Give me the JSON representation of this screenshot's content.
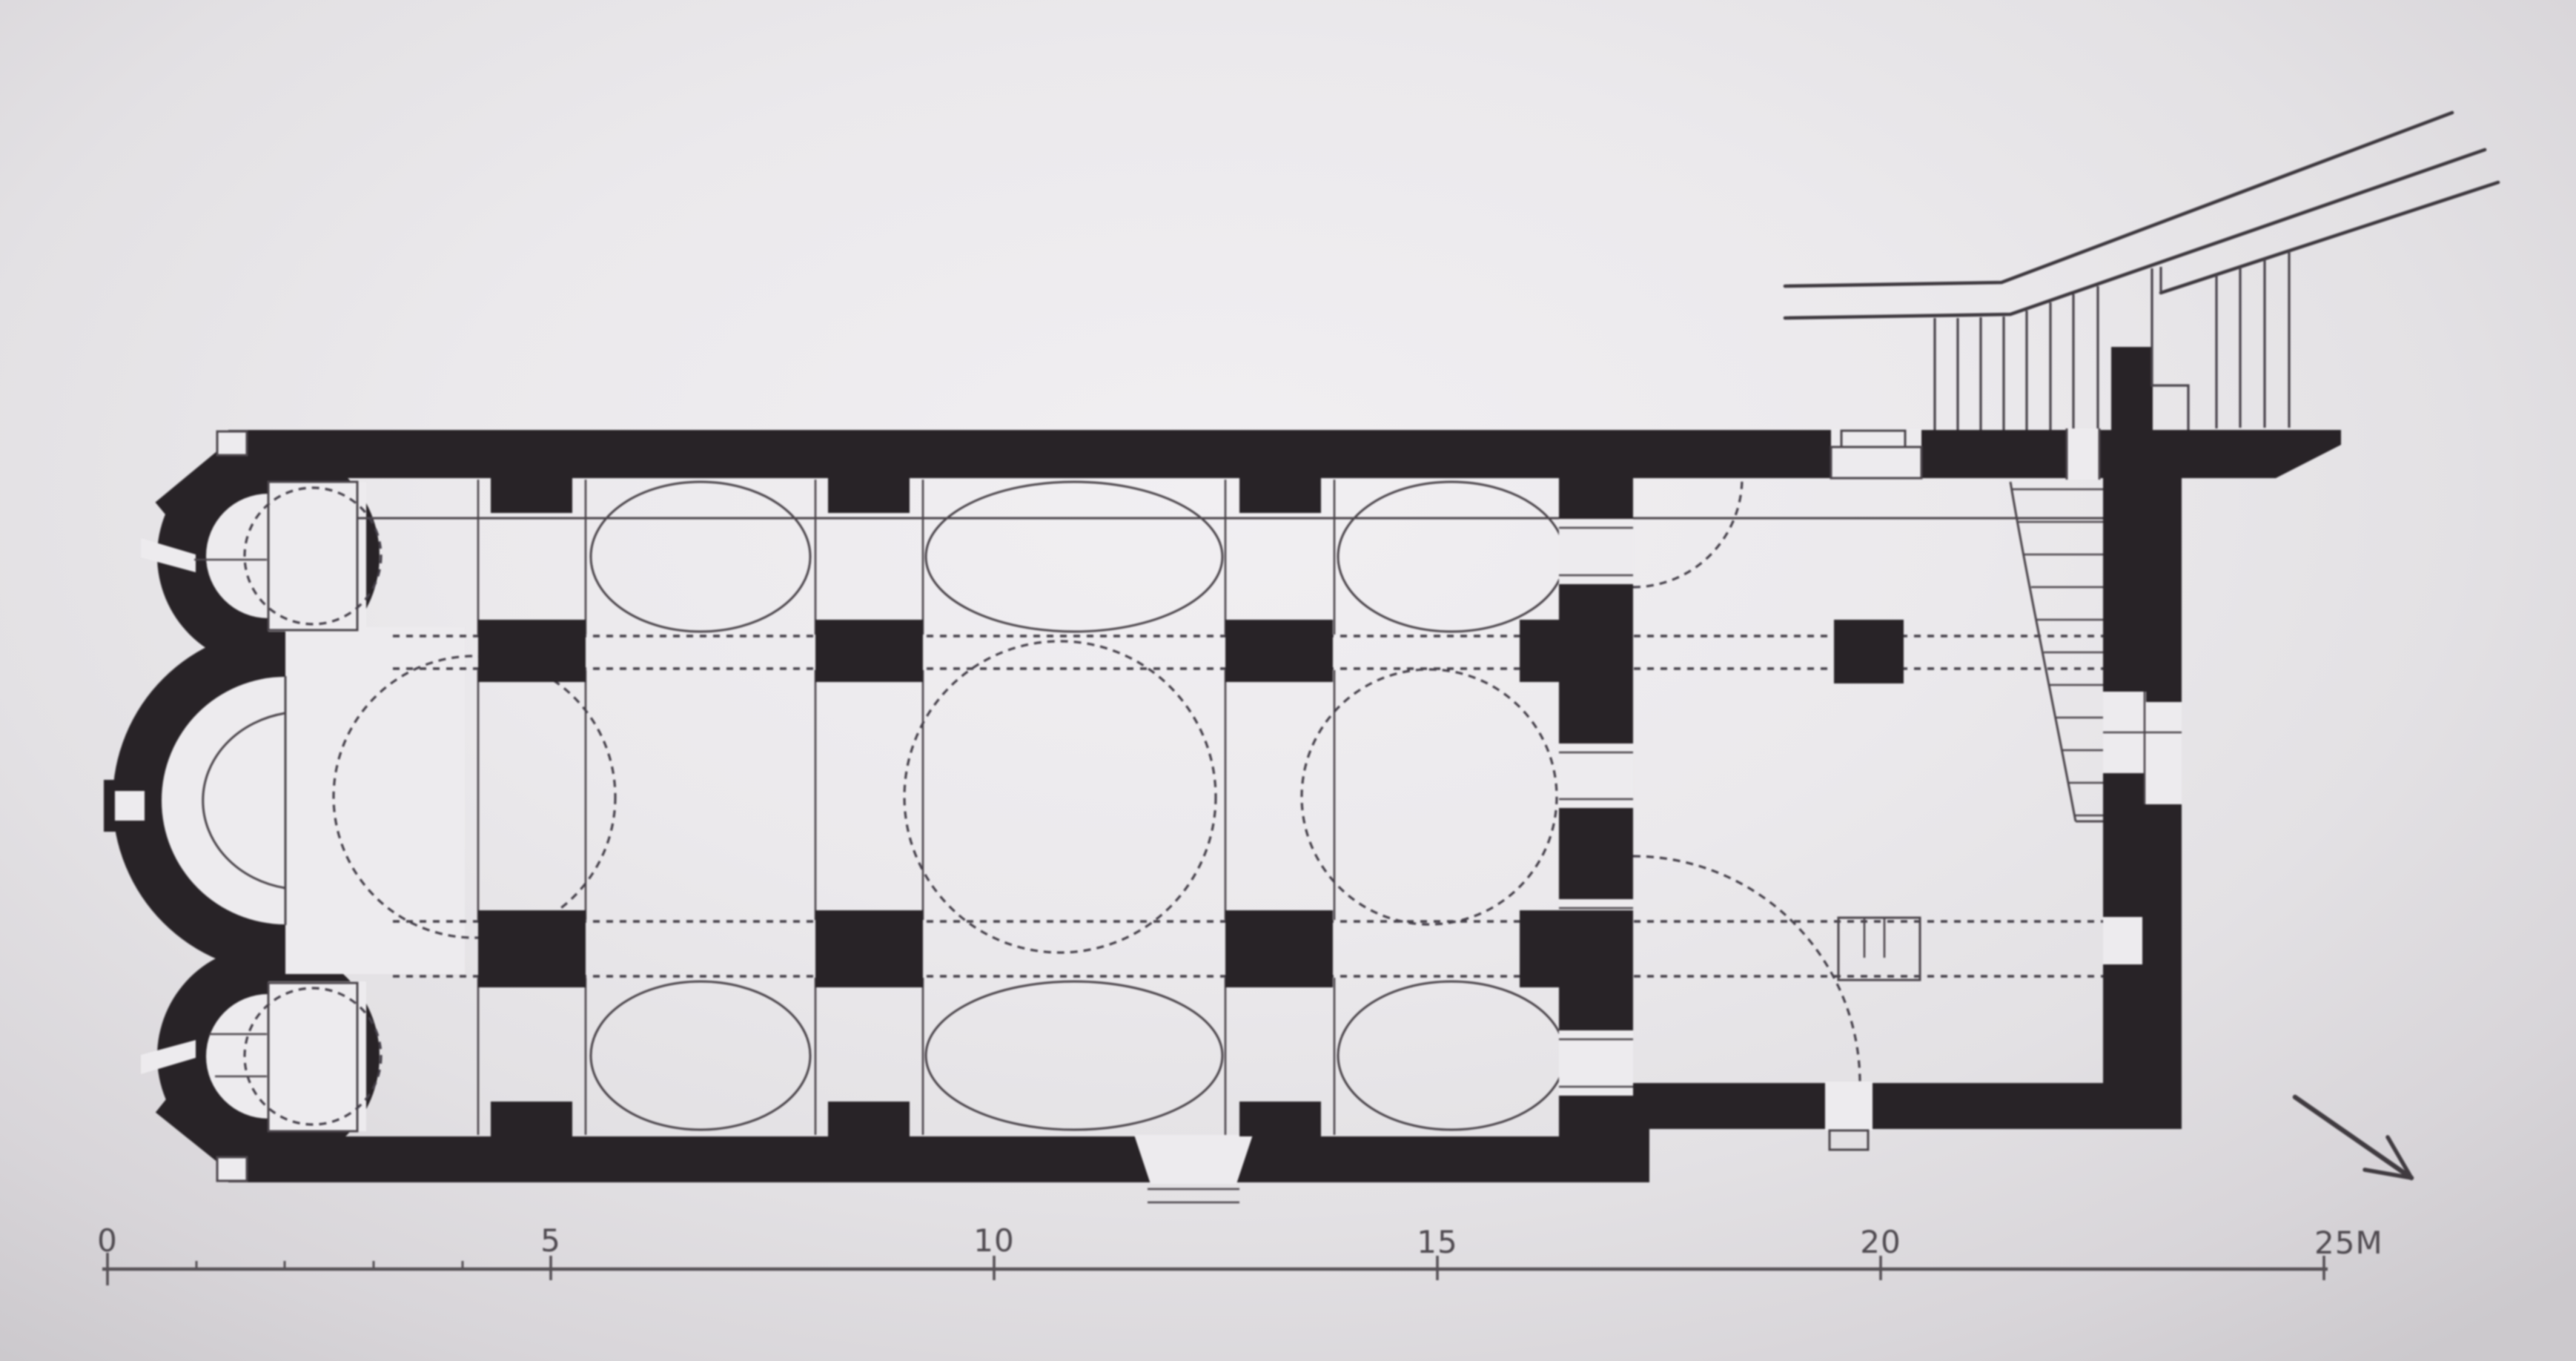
{
  "figure": {
    "type": "architectural-floor-plan",
    "subject": "photographed book figure: floor plan of a three-apsed church with domed naos, narthex with staircase, adjacent street lines at top right",
    "drawing_color": "black ink on light paper"
  },
  "scale_bar": {
    "unit": "M",
    "labels": [
      {
        "text": "0",
        "meters": 0
      },
      {
        "text": "5",
        "meters": 5
      },
      {
        "text": "10",
        "meters": 10
      },
      {
        "text": "15",
        "meters": 15
      },
      {
        "text": "20",
        "meters": 20
      },
      {
        "text": "25M",
        "meters": 25
      }
    ]
  },
  "icons": {
    "north_arrow": "diagonal-arrow-pointing-southeast"
  },
  "colors": {
    "paper": "#ebe9ec",
    "ink": "#282327",
    "thin_line": "#4b454b",
    "scale_line": "#565156"
  }
}
